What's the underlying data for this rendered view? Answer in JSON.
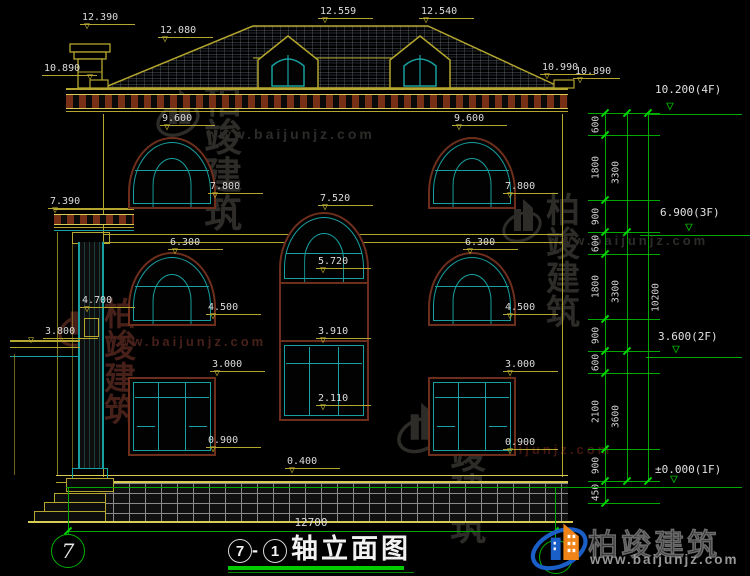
{
  "drawing": {
    "facade_markers": [
      "12.390",
      "12.080",
      "12.559",
      "12.540",
      "10.890",
      "10.990",
      "10.890",
      "9.600",
      "9.600",
      "7.800",
      "7.800",
      "7.520",
      "5.720",
      "6.300",
      "6.300",
      "4.500",
      "4.500",
      "3.000",
      "3.000",
      "3.910",
      "2.110",
      "0.900",
      "0.900",
      "0.400",
      "7.390",
      "4.700",
      "3.800"
    ],
    "level_markers": [
      "10.200(4F)",
      "6.900(3F)",
      "3.600(2F)",
      "±0.000(1F)"
    ],
    "dim_chain_1": [
      "600",
      "1800",
      "900",
      "600",
      "1800",
      "900",
      "600",
      "2100",
      "900",
      "450"
    ],
    "dim_chain_2": [
      "3300",
      "3300",
      "3600"
    ],
    "dim_chain_3": [
      "10200"
    ],
    "bottom_dim": "12700",
    "grid_left": "7",
    "title": {
      "left": "7",
      "sep": "-",
      "right": "1",
      "name": "轴立面图"
    }
  },
  "watermarks": {
    "brand": "柏竣建筑",
    "url": "www.baijunjz.com"
  },
  "logo": {
    "brand": "柏竣建筑",
    "url": "www.baijunjz.com"
  },
  "colors": {
    "line_yellow": "#b4a62e",
    "line_cyan": "#18a0a0",
    "line_green": "#00a800",
    "trim_brown": "#6e2e1c",
    "dentil_brown": "#772f16",
    "text_white": "#dcdcdc",
    "logo_blue": "#1a5fc8",
    "logo_orange": "#f08419",
    "watermark_gray": "#2e2c29",
    "watermark_maroon": "#47201a"
  }
}
